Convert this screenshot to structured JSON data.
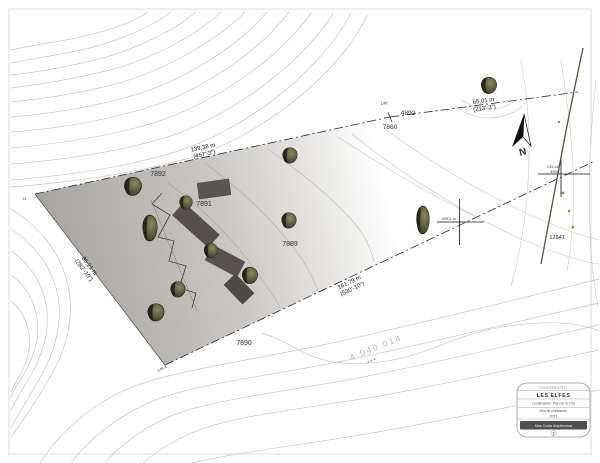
{
  "plan": {
    "parcels": {
      "p7892": "7892",
      "p7891": "7891",
      "p7889": "7889",
      "p7890": "7890",
      "p7860": "7860",
      "p4892": "4892",
      "p12841": "12841"
    },
    "dims": {
      "north": {
        "m": "139,38 m",
        "ft": "(457'-3\")"
      },
      "ne": {
        "m": "65,01 m",
        "ft": "(213'-3\")"
      },
      "south": {
        "m": "161,79 m",
        "ft": "(530'-10\")"
      },
      "west": {
        "m": "86,21 m",
        "ft": "(282'-10\")"
      }
    },
    "points": {
      "bend": "148",
      "corner_w": "14",
      "corner_s": "149.4",
      "cross_a": "459,1 m",
      "cross_b_top": "135,42",
      "cross_b_num": "4594"
    },
    "cadastral": "4 040 014",
    "cadastral_marks": "+      +      +",
    "north_label": "N",
    "colors": {
      "shade": "#a8a5a0",
      "building": "#57524d",
      "tree": "#5c5c40",
      "contour": "#c9c7c3",
      "stream": "#344d21"
    }
  },
  "titleblock": {
    "header": "Levantamientos",
    "name": "LES ELFES",
    "location": "Localización: Plan de la Cita",
    "caption": "Año de realización",
    "year": "2011",
    "firm": "Mas Costa Arquitectura",
    "sheet": "9"
  }
}
